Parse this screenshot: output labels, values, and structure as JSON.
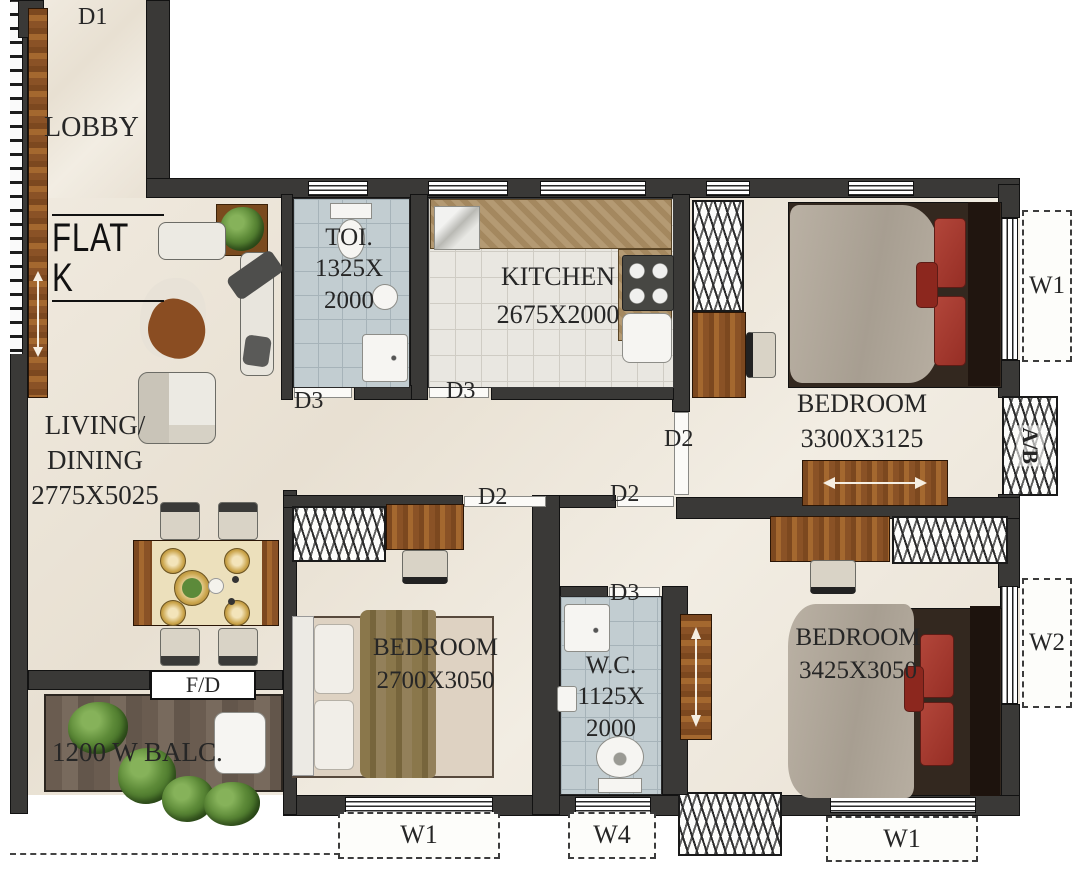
{
  "title": "Flat K floor plan",
  "flat": {
    "label": "FLAT K"
  },
  "doors": {
    "d1": "D1",
    "d3_toilet": "D3",
    "d3_kitchen": "D3",
    "d3_wc": "D3",
    "d2_bedroom1": "D2",
    "d2_bedroom2": "D2",
    "d2_bedroom3": "D2"
  },
  "windows": {
    "w1_top_right": "W1",
    "w2_right": "W2",
    "w1_bottom_left": "W1",
    "w4_bottom": "W4",
    "w1_bottom_right": "W1"
  },
  "shaft": {
    "label": "A/B"
  },
  "slider": {
    "label": "F/D"
  },
  "rooms": {
    "lobby": {
      "name": "LOBBY"
    },
    "living_dining": {
      "name_line1": "LIVING/",
      "name_line2": "DINING",
      "dimensions": "2775X5025"
    },
    "toilet": {
      "name": "TOI.",
      "dimensions_line1": "1325X",
      "dimensions_line2": "2000"
    },
    "kitchen": {
      "name": "KITCHEN",
      "dimensions": "2675X2000"
    },
    "bedroom_top_right": {
      "name": "BEDROOM",
      "dimensions": "3300X3125"
    },
    "bedroom_middle": {
      "name": "BEDROOM",
      "dimensions": "2700X3050"
    },
    "bedroom_bottom_right": {
      "name": "BEDROOM",
      "dimensions": "3425X3050"
    },
    "wc": {
      "name": "W.C.",
      "dimensions_line1": "1125X",
      "dimensions_line2": "2000"
    },
    "balcony": {
      "name": "1200 W BALC."
    }
  },
  "colors": {
    "wall": "#3a3937",
    "floor_cream": "#ece5d8",
    "tile_blue": "#c2cdd1",
    "wood": "#8a5226",
    "balcony_wood": "#6e6054",
    "bed_pillow_red": "#a63a2e",
    "blanket_gray": "#b4ab9e",
    "label_text": "#262626"
  }
}
